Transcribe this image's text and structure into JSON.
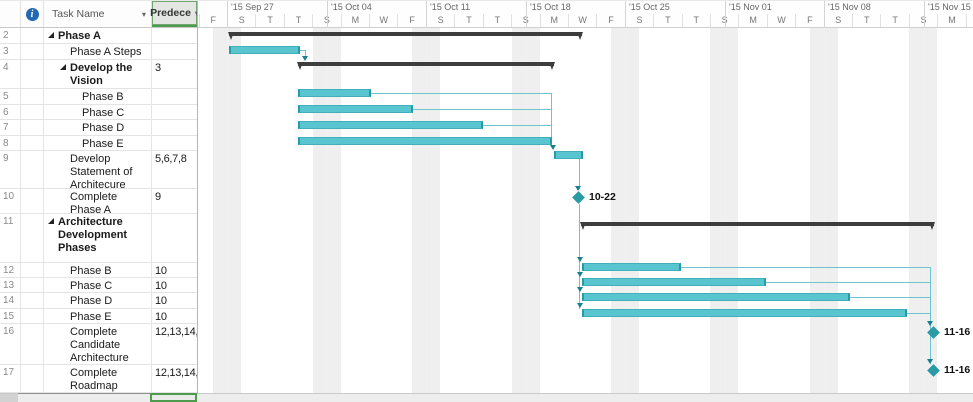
{
  "table": {
    "header": {
      "task_name": "Task Name",
      "predecessors": "Predece",
      "filter_arrow": "▾",
      "info_icon": "i"
    },
    "rows": [
      {
        "num": "2",
        "name": "Phase A",
        "pred": "",
        "level": 0,
        "summary": true,
        "h": 16
      },
      {
        "num": "3",
        "name": "Phase A Steps",
        "pred": "",
        "level": 1,
        "summary": false,
        "h": 16
      },
      {
        "num": "4",
        "name": "Develop the Vision",
        "pred": "3",
        "level": 1,
        "summary": true,
        "h": 29
      },
      {
        "num": "5",
        "name": "Phase B",
        "pred": "",
        "level": 2,
        "summary": false,
        "h": 16
      },
      {
        "num": "6",
        "name": "Phase C",
        "pred": "",
        "level": 2,
        "summary": false,
        "h": 15
      },
      {
        "num": "7",
        "name": "Phase D",
        "pred": "",
        "level": 2,
        "summary": false,
        "h": 16
      },
      {
        "num": "8",
        "name": "Phase E",
        "pred": "",
        "level": 2,
        "summary": false,
        "h": 15
      },
      {
        "num": "9",
        "name": "Develop Statement of Architecure Work",
        "pred": "5,6,7,8",
        "level": 1,
        "summary": false,
        "h": 38
      },
      {
        "num": "10",
        "name": "Complete Phase A",
        "pred": "9",
        "level": 1,
        "summary": false,
        "h": 25
      },
      {
        "num": "11",
        "name": "Architecture Development Phases",
        "pred": "",
        "level": 0,
        "summary": true,
        "h": 49
      },
      {
        "num": "12",
        "name": "Phase B",
        "pred": "10",
        "level": 1,
        "summary": false,
        "h": 15
      },
      {
        "num": "13",
        "name": "Phase C",
        "pred": "10",
        "level": 1,
        "summary": false,
        "h": 15
      },
      {
        "num": "14",
        "name": "Phase D",
        "pred": "10",
        "level": 1,
        "summary": false,
        "h": 16
      },
      {
        "num": "15",
        "name": "Phase E",
        "pred": "10",
        "level": 1,
        "summary": false,
        "h": 15
      },
      {
        "num": "16",
        "name": "Complete Candidate Architecture",
        "pred": "12,13,14,15",
        "level": 1,
        "summary": false,
        "h": 41
      },
      {
        "num": "17",
        "name": "Complete Roadmap",
        "pred": "12,13,14,15",
        "level": 1,
        "summary": false,
        "h": 28
      }
    ]
  },
  "timeline": {
    "weeks": [
      {
        "label": "'15 Sep 27",
        "x": 30
      },
      {
        "label": "'15 Oct 04",
        "x": 130
      },
      {
        "label": "'15 Oct 11",
        "x": 229
      },
      {
        "label": "'15 Oct 18",
        "x": 329
      },
      {
        "label": "'15 Oct 25",
        "x": 428
      },
      {
        "label": "'15 Nov 01",
        "x": 528
      },
      {
        "label": "'15 Nov 08",
        "x": 627
      },
      {
        "label": "'15 Nov 15",
        "x": 727
      }
    ],
    "day_labels": [
      "F",
      "S",
      "T",
      "T",
      "S",
      "M",
      "W",
      "F",
      "S",
      "T",
      "T",
      "S",
      "M",
      "W",
      "F",
      "S",
      "T",
      "T",
      "S",
      "M",
      "W",
      "F",
      "S",
      "T",
      "T",
      "S",
      "M",
      "W"
    ],
    "day_slot_width": 28.41,
    "day_start_x": 1.6
  },
  "chart_data": {
    "type": "gantt",
    "items": [
      {
        "row": "2",
        "task": "Phase A",
        "type": "summary",
        "x": 32,
        "y": 4,
        "w": 353
      },
      {
        "row": "3",
        "task": "Phase A Steps",
        "type": "task",
        "x": 32,
        "y": 18,
        "w": 71
      },
      {
        "row": "4",
        "task": "Develop the Vision",
        "type": "summary",
        "x": 101,
        "y": 34,
        "w": 256
      },
      {
        "row": "5",
        "task": "Phase B",
        "type": "task",
        "x": 101,
        "y": 61,
        "w": 73
      },
      {
        "row": "6",
        "task": "Phase C",
        "type": "task",
        "x": 101,
        "y": 77,
        "w": 115
      },
      {
        "row": "7",
        "task": "Phase D",
        "type": "task",
        "x": 101,
        "y": 93,
        "w": 185
      },
      {
        "row": "8",
        "task": "Phase E",
        "type": "task",
        "x": 101,
        "y": 109,
        "w": 254
      },
      {
        "row": "9",
        "task": "Develop Statement of Architecure Work",
        "type": "task",
        "x": 357,
        "y": 123,
        "w": 29
      },
      {
        "row": "10",
        "task": "Complete Phase A",
        "type": "milestone",
        "cx": 381,
        "cy": 169,
        "label": "10-22"
      },
      {
        "row": "11",
        "task": "Architecture Development Phases",
        "type": "summary",
        "x": 384,
        "y": 194,
        "w": 353
      },
      {
        "row": "12",
        "task": "Phase B",
        "type": "task",
        "x": 385,
        "y": 235,
        "w": 99
      },
      {
        "row": "13",
        "task": "Phase C",
        "type": "task",
        "x": 385,
        "y": 250,
        "w": 184
      },
      {
        "row": "14",
        "task": "Phase D",
        "type": "task",
        "x": 385,
        "y": 265,
        "w": 268
      },
      {
        "row": "15",
        "task": "Phase E",
        "type": "task",
        "x": 385,
        "y": 281,
        "w": 325
      },
      {
        "row": "16",
        "task": "Complete Candidate Architecture",
        "type": "milestone",
        "cx": 736,
        "cy": 304,
        "label": "11-16"
      },
      {
        "row": "17",
        "task": "Complete Roadmap",
        "type": "milestone",
        "cx": 736,
        "cy": 342,
        "label": "11-16"
      }
    ],
    "links": {
      "segments": [
        {
          "x": 103,
          "y": 22,
          "w": 6,
          "h": 1
        },
        {
          "x": 108,
          "y": 22,
          "w": 1,
          "h": 8
        },
        {
          "x": 174,
          "y": 65,
          "w": 180,
          "h": 1
        },
        {
          "x": 216,
          "y": 81,
          "w": 138,
          "h": 1
        },
        {
          "x": 286,
          "y": 97,
          "w": 68,
          "h": 1
        },
        {
          "x": 354,
          "y": 65,
          "w": 1,
          "h": 54
        },
        {
          "x": 382,
          "y": 131,
          "w": 1,
          "h": 30
        },
        {
          "x": 382,
          "y": 176,
          "w": 1,
          "h": 105
        },
        {
          "x": 484,
          "y": 239,
          "w": 249,
          "h": 1
        },
        {
          "x": 569,
          "y": 254,
          "w": 164,
          "h": 1
        },
        {
          "x": 653,
          "y": 269,
          "w": 80,
          "h": 1
        },
        {
          "x": 710,
          "y": 285,
          "w": 23,
          "h": 1
        },
        {
          "x": 733,
          "y": 239,
          "w": 1,
          "h": 97
        }
      ],
      "arrows": [
        {
          "x": 108,
          "y": 28
        },
        {
          "x": 356,
          "y": 117
        },
        {
          "x": 381,
          "y": 158
        },
        {
          "x": 383,
          "y": 229
        },
        {
          "x": 383,
          "y": 244
        },
        {
          "x": 383,
          "y": 259
        },
        {
          "x": 383,
          "y": 275
        },
        {
          "x": 733,
          "y": 293
        },
        {
          "x": 733,
          "y": 331
        }
      ]
    },
    "weekend_bands": [
      16,
      116,
      215,
      315,
      414,
      513,
      613,
      712
    ],
    "weekend_band_width": 28.4,
    "colors": {
      "bar_fill": "#58c5cf",
      "bar_edge": "#2899a6",
      "summary_bar": "#3d3d3d",
      "milestone": "#2a9aa4",
      "link_line": "#6ec4cd",
      "link_arrow": "#17818d",
      "weekend_band": "#efefef",
      "selection_green": "#4e9b4e",
      "info_icon_blue": "#2268b2"
    }
  }
}
